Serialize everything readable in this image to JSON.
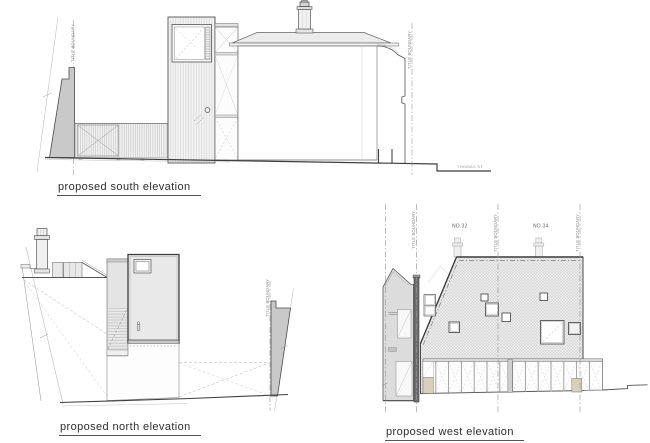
{
  "drawing": {
    "south": {
      "label": "proposed south elevation",
      "boundary_label": "TITLE BOUNDARY",
      "street_label": "THOMAS ST"
    },
    "north": {
      "label": "proposed north elevation",
      "boundary_label": "TITLE BOUNDARY"
    },
    "west": {
      "label": "proposed west elevation",
      "boundary_label": "TITLE BOUNDARY",
      "house_32": "NO.32",
      "house_34": "NO.34"
    }
  },
  "colors": {
    "background": "#ffffff",
    "linework": "#444444",
    "section_wall_fill": "#c9c9c9",
    "light_wall_fill": "#e8e8e8",
    "timber_block_fill": "#d8cfbd",
    "boundary_line": "#999999"
  }
}
